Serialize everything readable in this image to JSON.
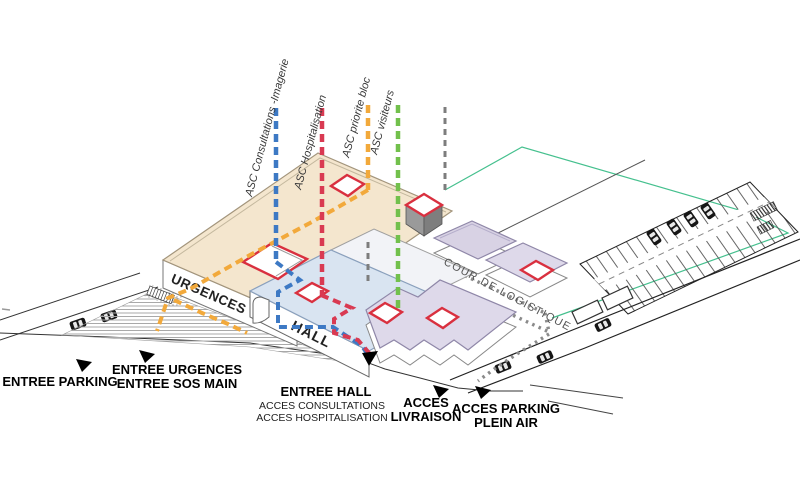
{
  "diagram_title": "Hospital site access axonometric diagram",
  "legend_lines": [
    {
      "label": "ASC Consultations -Imagerie",
      "color": "#3d79c4"
    },
    {
      "label": "ASC Hospitalisation",
      "color": "#d93a52"
    },
    {
      "label": "ASC priorite bloc",
      "color": "#f2a93b"
    },
    {
      "label": "ASC visiteurs",
      "color": "#72c04c"
    }
  ],
  "site": {
    "urgences_label": "URGENCES",
    "hall_label": "HALL",
    "cour_label": "COUR DE LOGISTIQUE"
  },
  "entrances": [
    {
      "id": "entree-parking",
      "lines": [
        "ENTREE PARKING"
      ]
    },
    {
      "id": "entree-urgences",
      "lines": [
        "ENTREE URGENCES",
        "ENTREE SOS MAIN"
      ]
    },
    {
      "id": "entree-hall",
      "lines": [
        "ENTREE HALL",
        "ACCES CONSULTATIONS",
        "ACCES HOSPITALISATION"
      ]
    },
    {
      "id": "acces-livraison",
      "lines": [
        "ACCES",
        "LIVRAISON"
      ]
    },
    {
      "id": "acces-parking",
      "lines": [
        "ACCES PARKING",
        "PLEIN AIR"
      ]
    }
  ],
  "colors": {
    "urgences_roof": "#f4e6ce",
    "hall_roof": "#d9e4f1",
    "bloc_roof": "#ded9ea",
    "patio_outline": "#d9303f",
    "site_boundary": "#45c08e",
    "logistics_dots": "#8a8a8a"
  }
}
